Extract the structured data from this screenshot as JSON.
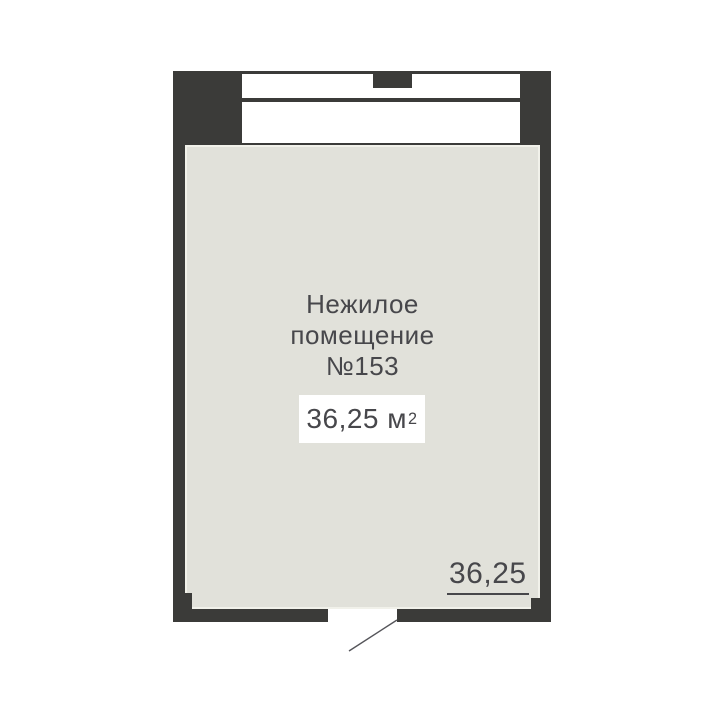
{
  "colors": {
    "background": "#ffffff",
    "wall": "#3b3b39",
    "floor": "#e1e1da",
    "floor_edge": "#f1f1ea",
    "window": "#ffffff",
    "text": "#47474b",
    "swing_line": "#55555a"
  },
  "floor_plan": {
    "room_label": {
      "lines": [
        "Нежилое",
        "помещение",
        "№153"
      ]
    },
    "area_badge": {
      "value": "36,25 м",
      "sup": "2"
    },
    "dimension_label": "36,25"
  }
}
